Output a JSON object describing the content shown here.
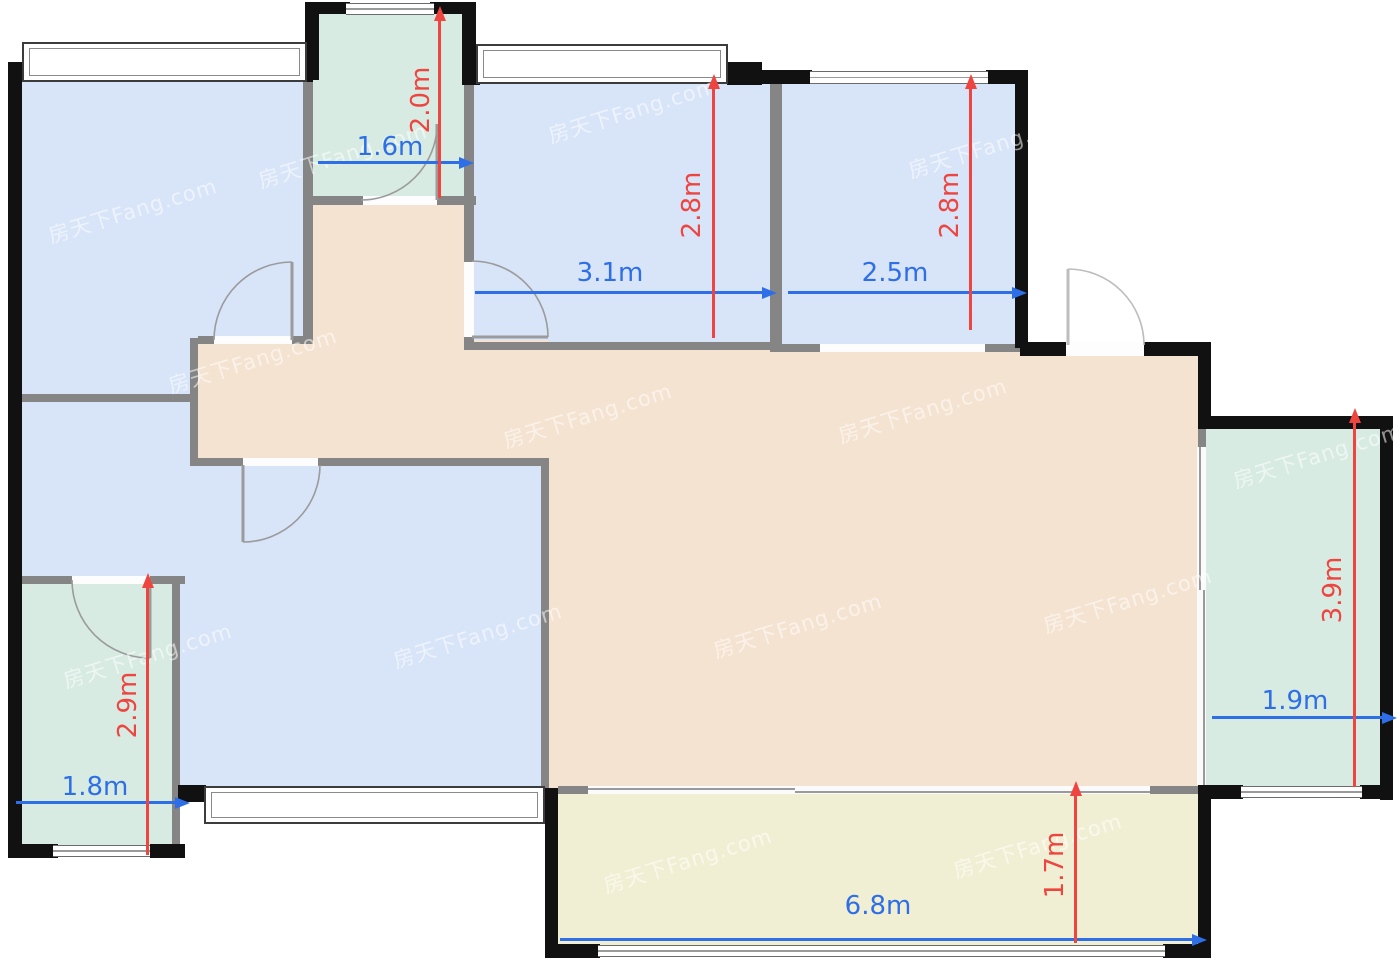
{
  "document": {
    "type": "apartment-floor-plan"
  },
  "watermark": {
    "text": "房天下Fang.com"
  },
  "colors": {
    "room_blue": "#d8e4f8",
    "room_teal": "#d7ebe3",
    "room_beige": "#f4e3d0",
    "room_yellow": "#f1efd3",
    "wall_outer": "#111111",
    "wall_inner": "#858585",
    "dimension_blue": "#2e6fe8",
    "dimension_red": "#ee4540"
  },
  "rooms": [
    {
      "id": "bedroom-top-left",
      "fill": "room_blue"
    },
    {
      "id": "bathroom-top",
      "fill": "room_teal"
    },
    {
      "id": "bedroom-middle",
      "fill": "room_blue"
    },
    {
      "id": "bedroom-right",
      "fill": "room_blue"
    },
    {
      "id": "hallway-living-dining",
      "fill": "room_beige"
    },
    {
      "id": "bedroom-bottom-left",
      "fill": "room_blue"
    },
    {
      "id": "bathroom-bottom-left",
      "fill": "room_teal"
    },
    {
      "id": "balcony-right",
      "fill": "room_teal"
    },
    {
      "id": "balcony-bottom",
      "fill": "room_yellow"
    }
  ],
  "dimensions": [
    {
      "room": "bathroom-top",
      "axis": "width",
      "label": "1.6m"
    },
    {
      "room": "bathroom-top",
      "axis": "height",
      "label": "2.0m"
    },
    {
      "room": "bedroom-middle",
      "axis": "width",
      "label": "3.1m"
    },
    {
      "room": "bedroom-middle",
      "axis": "height",
      "label": "2.8m"
    },
    {
      "room": "bedroom-right",
      "axis": "width",
      "label": "2.5m"
    },
    {
      "room": "bedroom-right",
      "axis": "height",
      "label": "2.8m"
    },
    {
      "room": "balcony-right",
      "axis": "width",
      "label": "1.9m"
    },
    {
      "room": "balcony-right",
      "axis": "height",
      "label": "3.9m"
    },
    {
      "room": "bathroom-bottom-left",
      "axis": "width",
      "label": "1.8m"
    },
    {
      "room": "bathroom-bottom-left",
      "axis": "height",
      "label": "2.9m"
    },
    {
      "room": "balcony-bottom",
      "axis": "width",
      "label": "6.8m"
    },
    {
      "room": "balcony-bottom",
      "axis": "height",
      "label": "1.7m"
    }
  ]
}
